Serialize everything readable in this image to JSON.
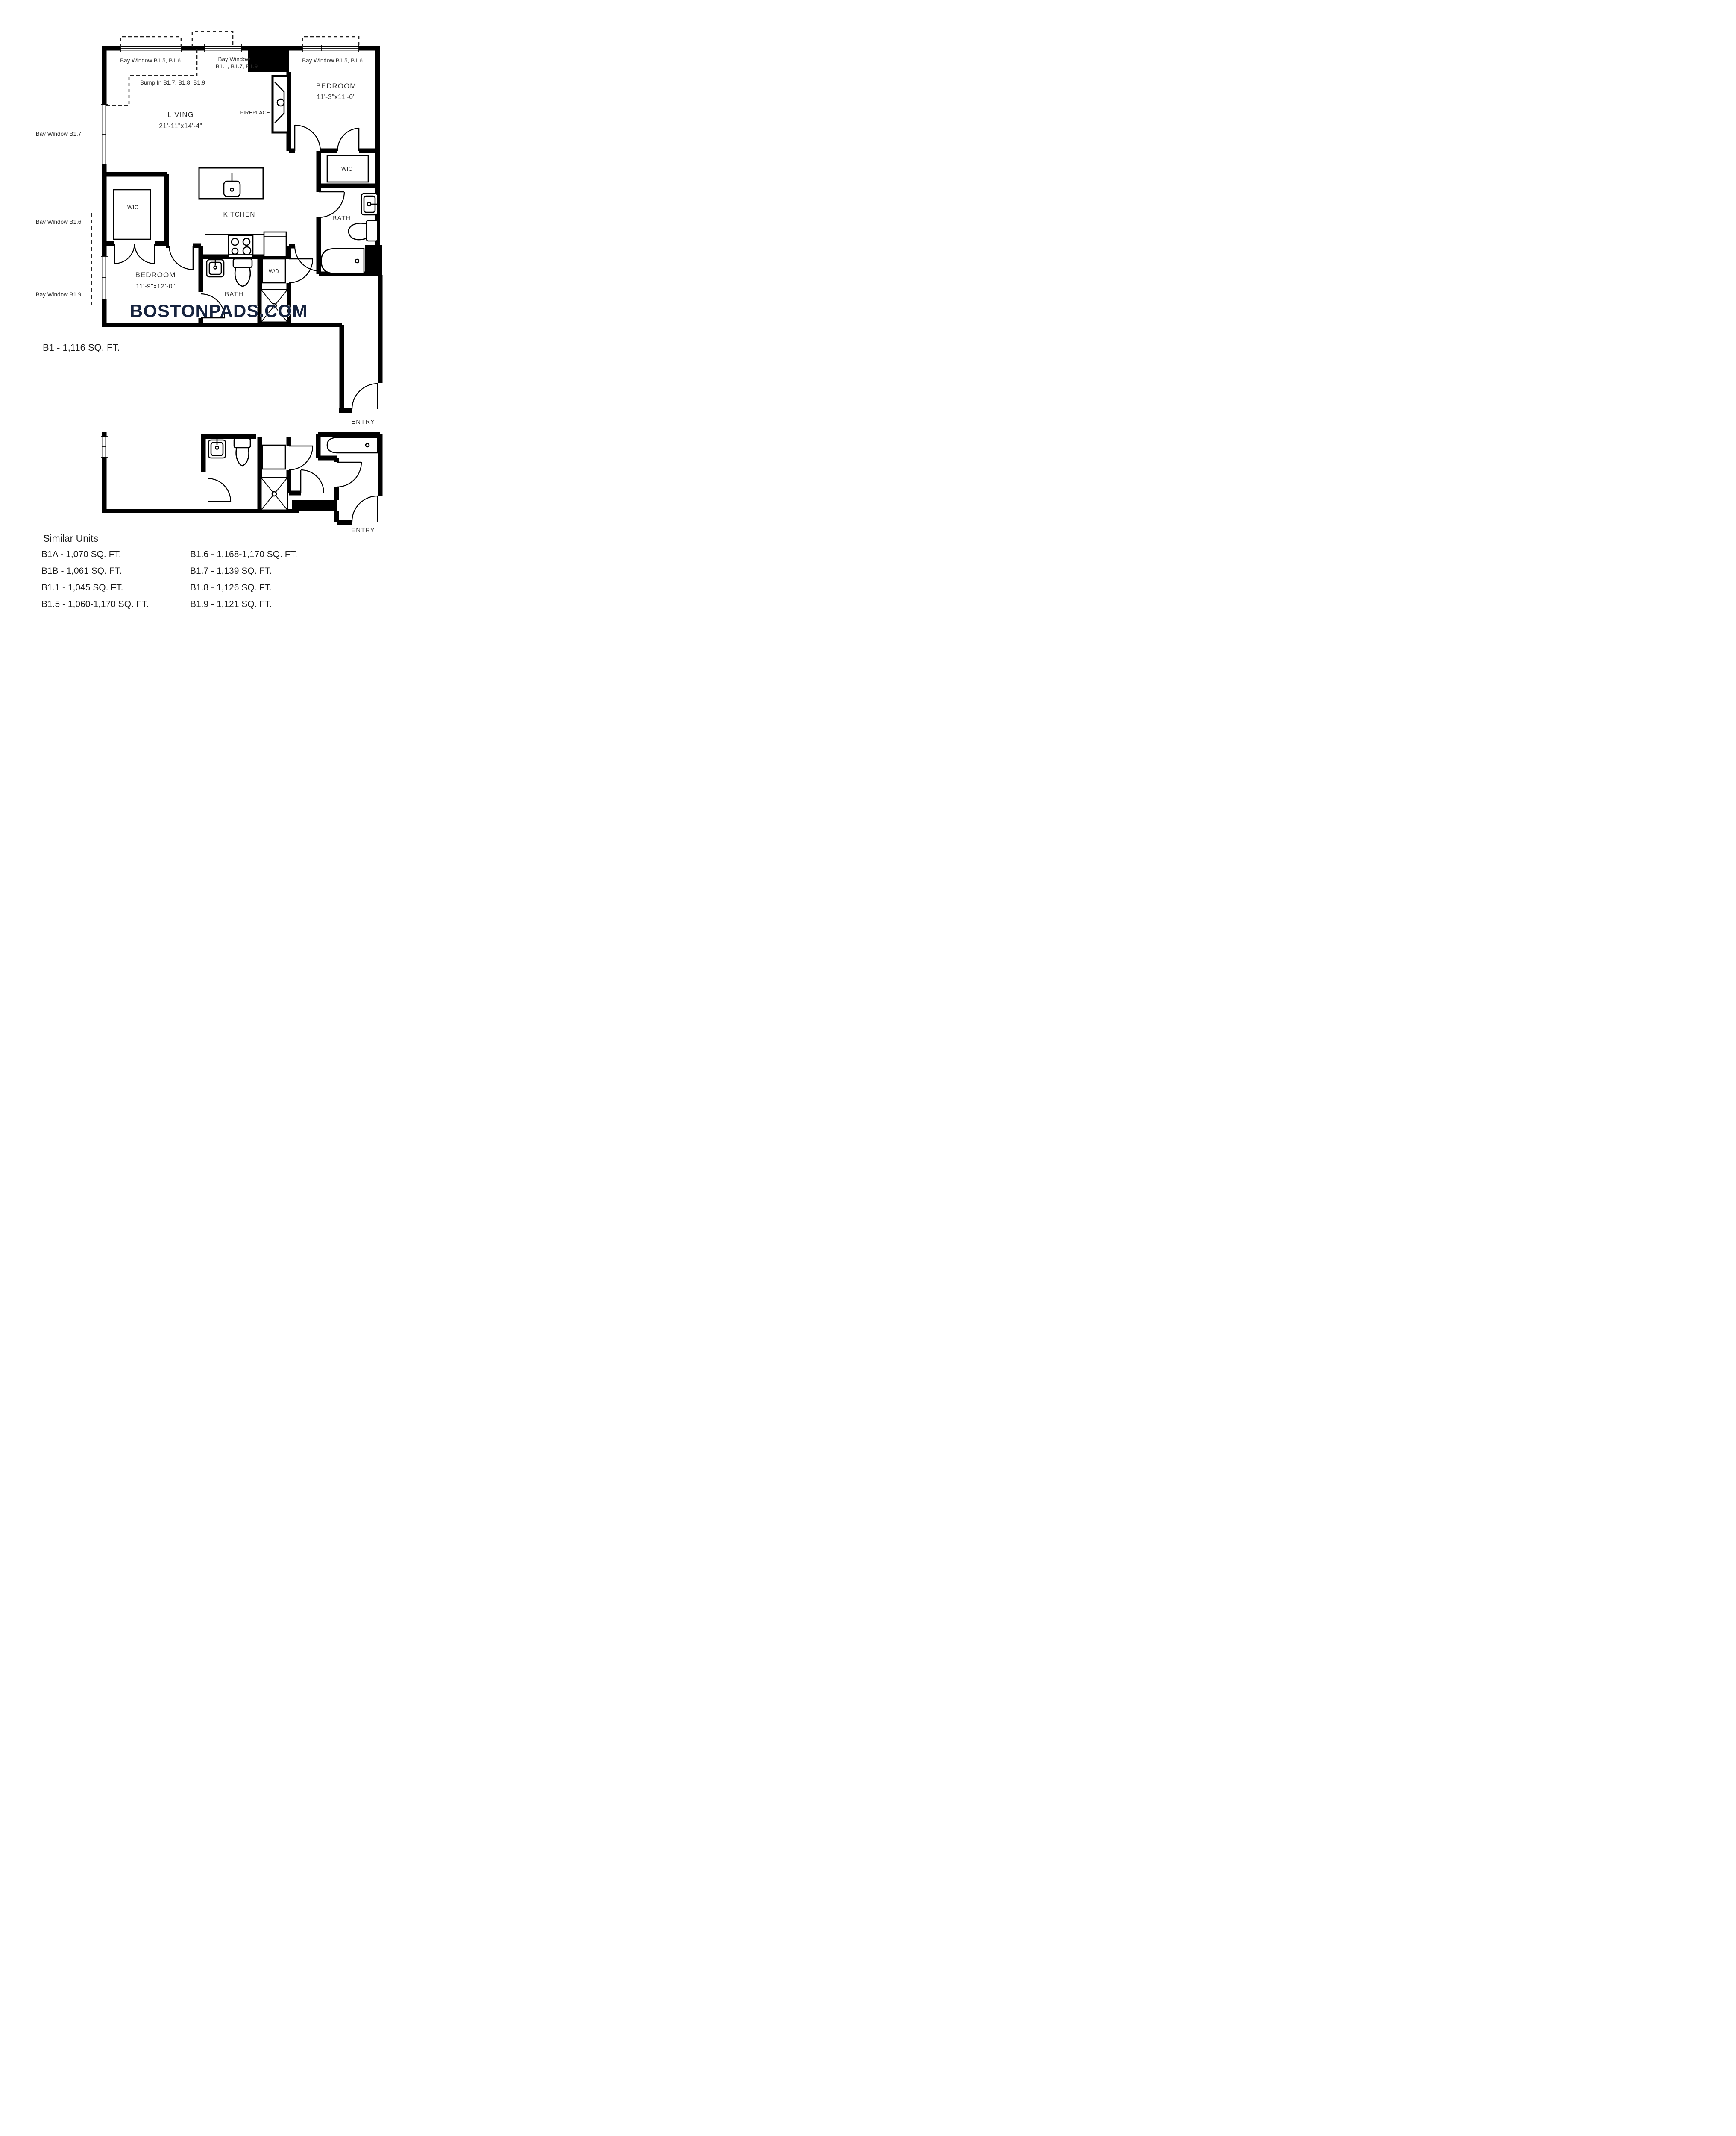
{
  "watermark": {
    "text": "BOSTONPADS.COM",
    "color": "#16233e"
  },
  "plan": {
    "title": "B1 - 1,116 SQ. FT.",
    "annotations": {
      "bay_top_left": "Bay Window B1.5, B1.6",
      "bay_top_mid_1": "Bay Window",
      "bay_top_mid_2": "B1.1, B1.7, B1.9",
      "bay_top_right": "Bay Window B1.5, B1.6",
      "bump_in": "Bump In B1.7, B1.8, B1.9",
      "bay_left_upper": "Bay Window B1.7",
      "bay_left_mid": "Bay Window B1.6",
      "bay_left_lower": "Bay Window B1.9"
    },
    "rooms": {
      "living": {
        "name": "LIVING",
        "dims": "21'-11\"x14'-4\""
      },
      "bedroom1": {
        "name": "BEDROOM",
        "dims": "11'-3\"x11'-0\""
      },
      "bedroom2": {
        "name": "BEDROOM",
        "dims": "11'-9\"x12'-0\""
      },
      "kitchen": "KITCHEN",
      "bath1": "BATH",
      "bath2": "BATH",
      "wic1": "WIC",
      "wic2": "WIC",
      "fireplace": "FIREPLACE",
      "wd": "W/D",
      "entry1": "ENTRY",
      "entry2": "ENTRY"
    }
  },
  "similar_units": {
    "heading": "Similar Units",
    "left": [
      "B1A - 1,070 SQ. FT.",
      "B1B - 1,061 SQ. FT.",
      "B1.1 - 1,045 SQ. FT.",
      "B1.5 - 1,060-1,170 SQ. FT."
    ],
    "right": [
      "B1.6 - 1,168-1,170 SQ. FT.",
      "B1.7 - 1,139 SQ. FT.",
      "B1.8 - 1,126 SQ. FT.",
      "B1.9 - 1,121 SQ. FT."
    ]
  }
}
